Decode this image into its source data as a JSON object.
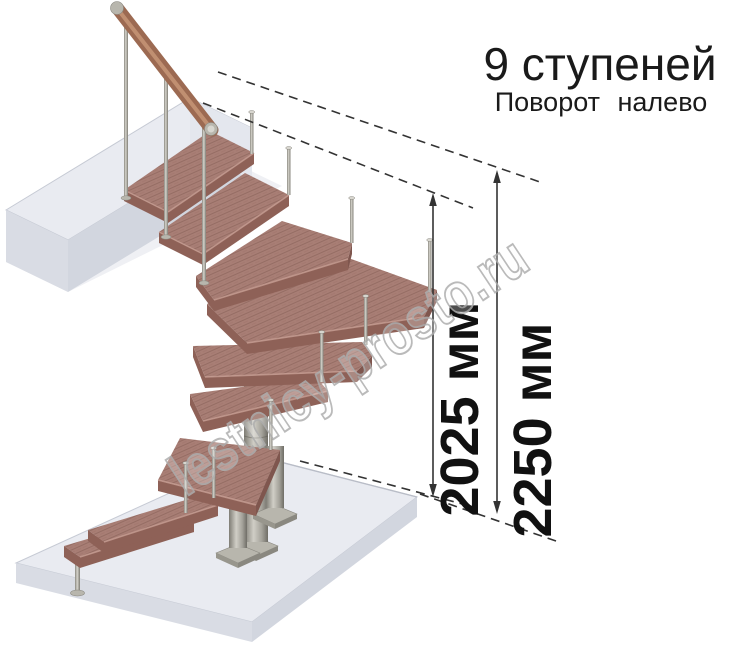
{
  "title": {
    "line1": "9 ступеней",
    "line2": "Поворот налево"
  },
  "stairs": {
    "steps_total": 9,
    "turn_direction": "налево"
  },
  "dimensions": {
    "inner": {
      "value": 2025,
      "unit": "мм",
      "label": "2025 мм"
    },
    "outer": {
      "value": 2250,
      "unit": "мм",
      "label": "2250 мм"
    }
  },
  "watermark": {
    "text": "lestnicy-prosto.ru"
  },
  "colors": {
    "wood_top": "#a87e75",
    "wood_side": "#8e6157",
    "wood_edge": "#c79e93",
    "rail_wood": "#9c6a52",
    "rail_light": "#d9a887",
    "metal": "#b8b6ad",
    "metal_light": "#d8d6cf",
    "metal_dark": "#7e7c74",
    "slab_top": "#e9ebf1",
    "slab_side": "#d9dce4",
    "slab_side2": "#d2d6df",
    "slab_end": "#e4e7ee",
    "dim": "#333333",
    "text": "#1a1a1a",
    "watermark_stroke": "#aeaeae"
  }
}
